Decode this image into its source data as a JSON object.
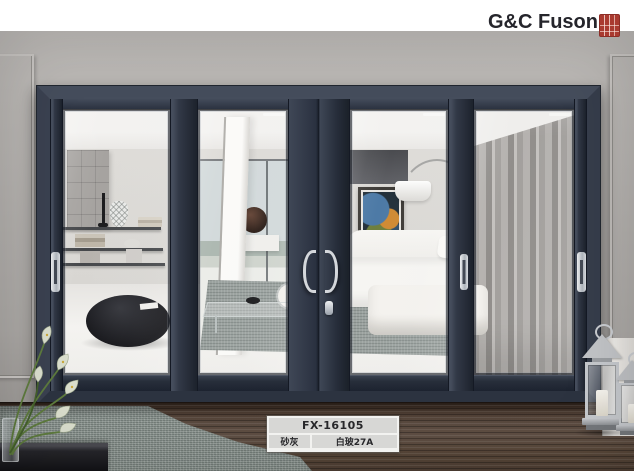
{
  "brand": {
    "name": "G&C Fuson",
    "seal_icon": "red-chinese-seal-stamp"
  },
  "product_label": {
    "model": "FX-16105",
    "frame_color": "砂灰",
    "glass_spec": "白玻27A"
  },
  "palette": {
    "header_bg": "#ffffff",
    "logo_text": "#25252b",
    "seal_red": "#a93a30",
    "wall_gray": "#b4b1ae",
    "door_frame": "#39404d",
    "glass_bevel": "#1d2431",
    "handle_chrome": "#d4d7db",
    "deck_brown": "#54453c",
    "rug_gray": "#8c9590",
    "curtain_gray": "#a3a09d",
    "label_cell": "#d7d7d5",
    "label_text": "#27272a"
  }
}
